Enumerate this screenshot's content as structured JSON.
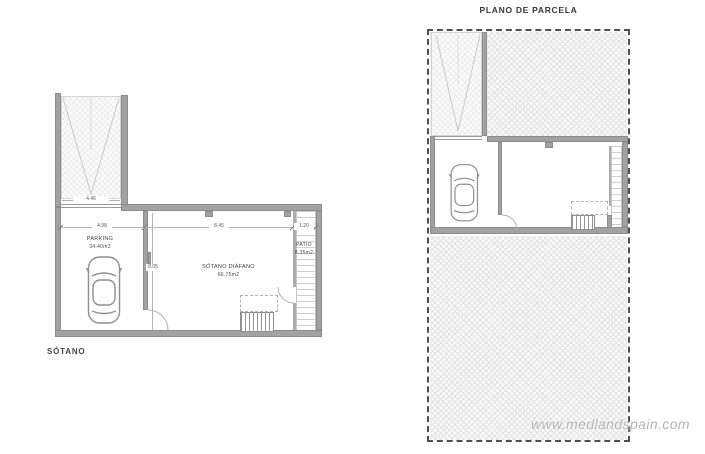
{
  "sheet": {
    "background": "#ffffff"
  },
  "colors": {
    "wall": "#a2a2a2",
    "wall_edge": "#8d8d8d",
    "hatch_line": "#e2e2e2",
    "parcel_boundary": "#4f4f4f",
    "label_text": "#3d3d3d",
    "dimension_text": "#5a5a5a",
    "watermark_text": "#b4b4b4"
  },
  "left_plan": {
    "caption": "SÓTANO",
    "rooms": {
      "parking": {
        "label": "PARKING",
        "area": "34.40m2"
      },
      "diafano": {
        "label": "SÓTANO DIÁFANO",
        "area": "66.75m2"
      },
      "patio": {
        "label": "PATIO",
        "area": "8.35m2"
      }
    },
    "dims": {
      "driveway_width": "4.46",
      "parking_width": "4.98",
      "diafano_width": "8.45",
      "patio_width": "1.20",
      "room_depth": "8.05"
    }
  },
  "right_plan": {
    "title": "PLANO DE PARCELA"
  },
  "watermark": "www.medlandspain.com"
}
